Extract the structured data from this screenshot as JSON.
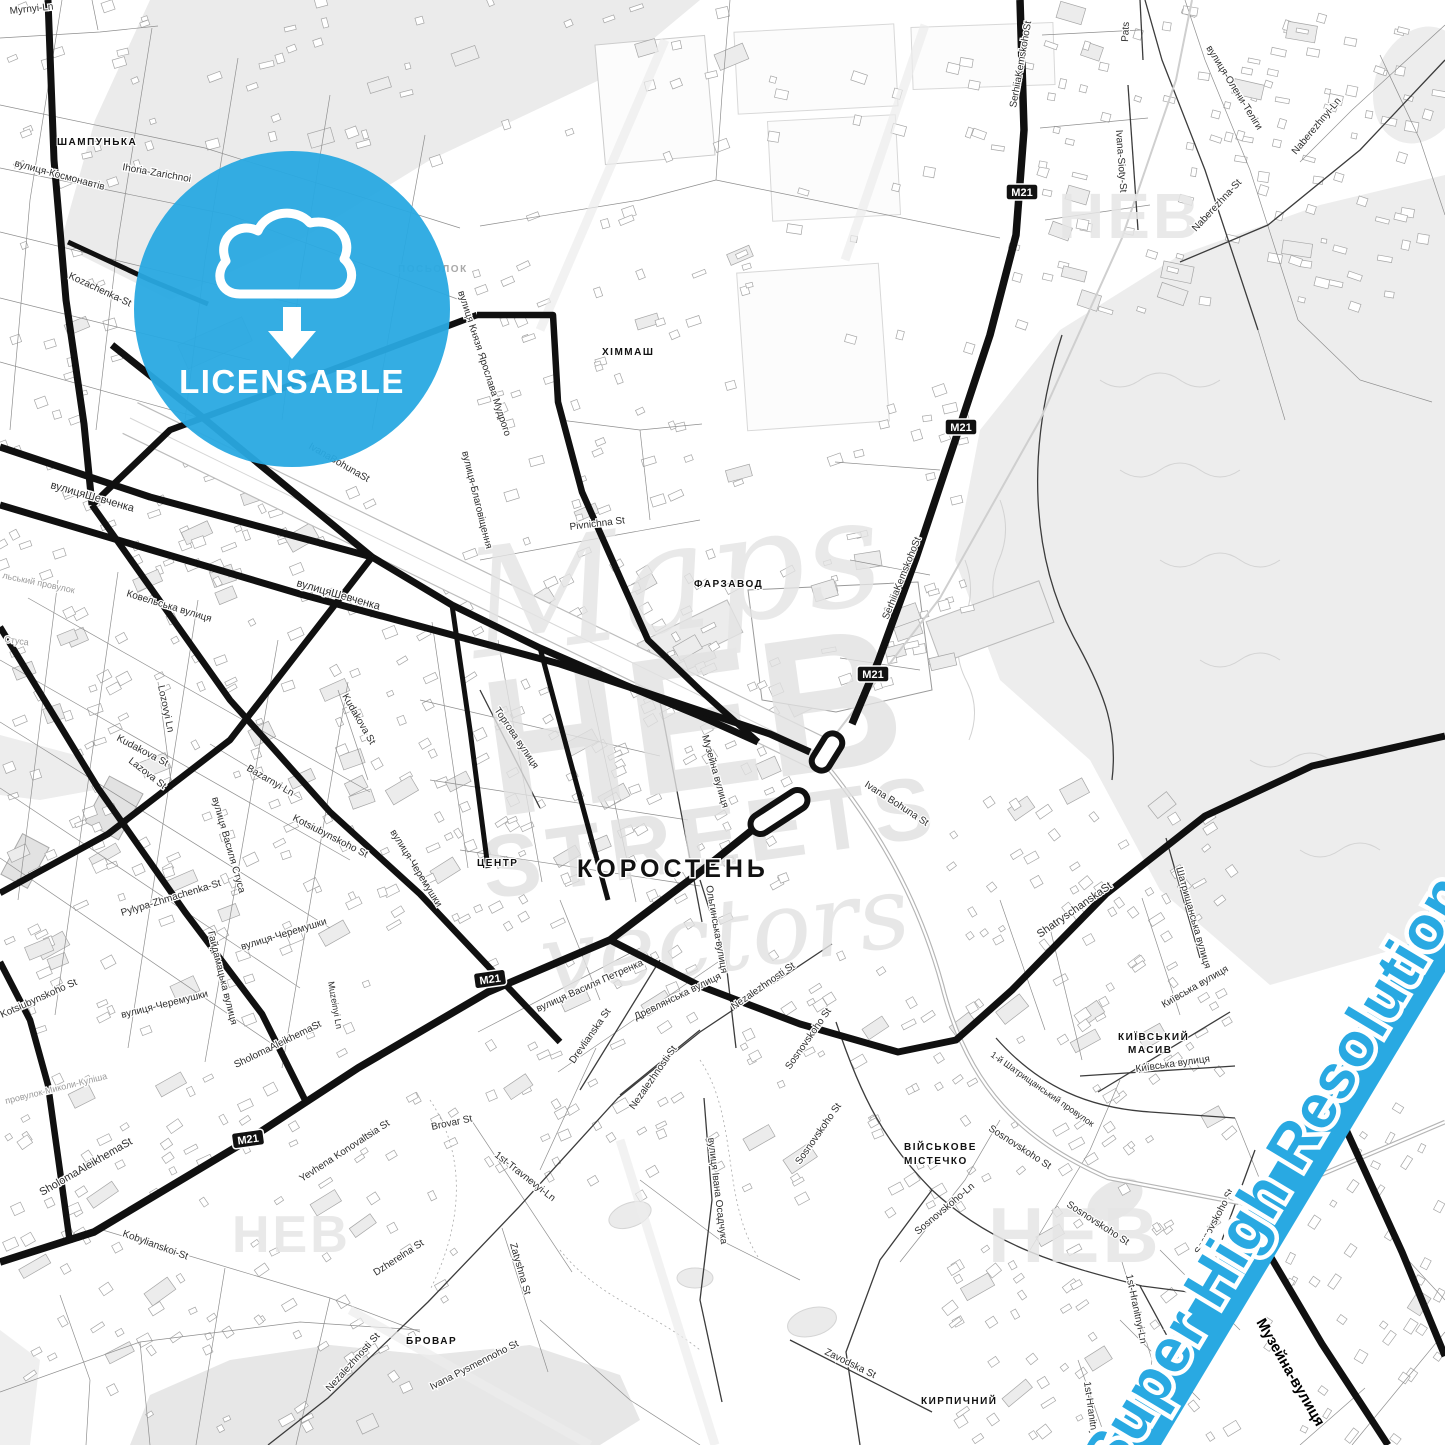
{
  "badge": {
    "label": "LICENSABLE",
    "color": "#29a9e2",
    "icon": "cloud-download"
  },
  "river_label": "Super High Resolution",
  "river_color": "#29a9e2",
  "shield_label": "M21",
  "shields": [
    {
      "x": 1022,
      "y": 192,
      "r": 0
    },
    {
      "x": 961,
      "y": 427,
      "r": 0
    },
    {
      "x": 873,
      "y": 674,
      "r": 0
    },
    {
      "x": 490,
      "y": 979,
      "r": -8
    },
    {
      "x": 248,
      "y": 1139,
      "r": -8
    }
  ],
  "watermark": {
    "line1": "Maps",
    "line2": "HEB",
    "line3": "STREETS",
    "line4": "vectors",
    "corner": "HEB"
  },
  "districts": [
    {
      "t": "ШАМПУНЬКА",
      "x": 57,
      "y": 145,
      "s": 10,
      "g": 0
    },
    {
      "t": "ПОСЬОЛОК",
      "x": 398,
      "y": 272,
      "s": 10,
      "g": 1
    },
    {
      "t": "ХІММАШ",
      "x": 602,
      "y": 355,
      "s": 10,
      "g": 0
    },
    {
      "t": "ФАРЗАВОД",
      "x": 694,
      "y": 587,
      "s": 10,
      "g": 0
    },
    {
      "t": "ЦЕНТР",
      "x": 477,
      "y": 866,
      "s": 10,
      "g": 0
    },
    {
      "t": "КОРОСТЕНЬ",
      "x": 577,
      "y": 877,
      "s": 25,
      "g": 0
    },
    {
      "t": "КИЇВСЬКИЙ",
      "x": 1118,
      "y": 1040,
      "s": 10,
      "g": 0
    },
    {
      "t": "МАСИВ",
      "x": 1128,
      "y": 1053,
      "s": 10,
      "g": 0
    },
    {
      "t": "ВІЙСЬКОВЕ",
      "x": 904,
      "y": 1150,
      "s": 10,
      "g": 0
    },
    {
      "t": "МІСТЕЧКО",
      "x": 904,
      "y": 1164,
      "s": 10,
      "g": 0
    },
    {
      "t": "БРОВАР",
      "x": 406,
      "y": 1344,
      "s": 10,
      "g": 0
    },
    {
      "t": "КИРПИЧНИЙ",
      "x": 921,
      "y": 1404,
      "s": 10,
      "g": 0
    }
  ],
  "streets": [
    {
      "t": "Myrnyi-Ln",
      "x": 10,
      "y": 14,
      "r": -6,
      "s": 10,
      "c": "d"
    },
    {
      "t": "вулиця-Космонавтів",
      "x": 14,
      "y": 166,
      "r": 15,
      "s": 10,
      "c": "d"
    },
    {
      "t": "Ihoria-Zarichnoi",
      "x": 122,
      "y": 170,
      "r": 10,
      "s": 10,
      "c": "d"
    },
    {
      "t": "Kozachenka-St",
      "x": 68,
      "y": 278,
      "r": 25,
      "s": 10,
      "c": "d"
    },
    {
      "t": "вулиця Князя Ярослава Мудрого",
      "x": 458,
      "y": 292,
      "r": 72,
      "s": 10,
      "c": "d"
    },
    {
      "t": "вулиця-Благовіщення",
      "x": 462,
      "y": 452,
      "r": 76,
      "s": 10,
      "c": "d"
    },
    {
      "t": "Pivnichna St",
      "x": 570,
      "y": 530,
      "r": -7,
      "s": 10,
      "c": "d"
    },
    {
      "t": "вулицяШевченка",
      "x": 50,
      "y": 488,
      "r": 16,
      "s": 11,
      "c": "d"
    },
    {
      "t": "вулицяШевченка",
      "x": 296,
      "y": 586,
      "r": 16,
      "s": 11,
      "c": "d"
    },
    {
      "t": "IvanaBohunaSt",
      "x": 308,
      "y": 448,
      "r": 30,
      "s": 10,
      "c": "d"
    },
    {
      "t": "Ковельська вулиця",
      "x": 126,
      "y": 596,
      "r": 17,
      "s": 10,
      "c": "d"
    },
    {
      "t": "льський провулок",
      "x": 2,
      "y": 578,
      "r": 12,
      "s": 9,
      "c": "g"
    },
    {
      "t": "Стуса",
      "x": 4,
      "y": 642,
      "r": 8,
      "s": 9,
      "c": "g"
    },
    {
      "t": "Lozovyi Ln",
      "x": 158,
      "y": 686,
      "r": 78,
      "s": 10,
      "c": "d"
    },
    {
      "t": "Kudakova St",
      "x": 116,
      "y": 740,
      "r": 28,
      "s": 10,
      "c": "d"
    },
    {
      "t": "Kudakova St",
      "x": 342,
      "y": 696,
      "r": 60,
      "s": 10,
      "c": "d"
    },
    {
      "t": "Lazova St",
      "x": 128,
      "y": 762,
      "r": 38,
      "s": 10,
      "c": "d"
    },
    {
      "t": "Bazarnyi Ln",
      "x": 246,
      "y": 770,
      "r": 30,
      "s": 10,
      "c": "d"
    },
    {
      "t": "вулиця Василя Стуса",
      "x": 212,
      "y": 798,
      "r": 74,
      "s": 10,
      "c": "d"
    },
    {
      "t": "Kotsiubynskoho St",
      "x": 292,
      "y": 820,
      "r": 27,
      "s": 10,
      "c": "d"
    },
    {
      "t": "вулиця-Черемушки",
      "x": 390,
      "y": 832,
      "r": 58,
      "s": 10,
      "c": "d"
    },
    {
      "t": "Pylypa-Zhmachenka-St",
      "x": 122,
      "y": 916,
      "r": -17,
      "s": 10,
      "c": "d"
    },
    {
      "t": "вулиця-Черемушки",
      "x": 242,
      "y": 950,
      "r": -17,
      "s": 10,
      "c": "d"
    },
    {
      "t": "Гайдамацька вулиця",
      "x": 208,
      "y": 932,
      "r": 76,
      "s": 10,
      "c": "d"
    },
    {
      "t": "вулиця-Черемушки",
      "x": 122,
      "y": 1018,
      "r": -14,
      "s": 10,
      "c": "d"
    },
    {
      "t": "Kotsiubynskoho St",
      "x": 2,
      "y": 1018,
      "r": -24,
      "s": 10,
      "c": "d"
    },
    {
      "t": "Muzeinyi Ln",
      "x": 328,
      "y": 982,
      "r": 80,
      "s": 9,
      "c": "d"
    },
    {
      "t": "SholomaAleikhemaSt",
      "x": 236,
      "y": 1068,
      "r": -26,
      "s": 10,
      "c": "d"
    },
    {
      "t": "SholomaAleikhemaSt",
      "x": 42,
      "y": 1196,
      "r": -30,
      "s": 11,
      "c": "d"
    },
    {
      "t": "провулок-Миколи-Куліша",
      "x": 6,
      "y": 1104,
      "r": -14,
      "s": 9,
      "c": "g"
    },
    {
      "t": "Kobylianskoi-St",
      "x": 122,
      "y": 1236,
      "r": 20,
      "s": 10,
      "c": "d"
    },
    {
      "t": "Yevhena Konovaltsia St",
      "x": 302,
      "y": 1182,
      "r": -33,
      "s": 10,
      "c": "d"
    },
    {
      "t": "Brovar St",
      "x": 432,
      "y": 1130,
      "r": -12,
      "s": 10,
      "c": "d"
    },
    {
      "t": "Dzherelna St",
      "x": 376,
      "y": 1276,
      "r": -33,
      "s": 10,
      "c": "d"
    },
    {
      "t": "Nezalezhnosti St",
      "x": 330,
      "y": 1392,
      "r": -48,
      "s": 10,
      "c": "d"
    },
    {
      "t": "Ivana Pysmennoho St",
      "x": 432,
      "y": 1390,
      "r": -27,
      "s": 10,
      "c": "d"
    },
    {
      "t": "1st-Travnevyi-Ln",
      "x": 494,
      "y": 1156,
      "r": 38,
      "s": 10,
      "c": "d"
    },
    {
      "t": "Zatyshna St",
      "x": 510,
      "y": 1244,
      "r": 74,
      "s": 10,
      "c": "d"
    },
    {
      "t": "вулиця Василя Петренка",
      "x": 538,
      "y": 1012,
      "r": -24,
      "s": 10,
      "c": "d"
    },
    {
      "t": "Древлянська вулиця",
      "x": 636,
      "y": 1020,
      "r": -26,
      "s": 10,
      "c": "d"
    },
    {
      "t": "Drevlianska St",
      "x": 574,
      "y": 1064,
      "r": -55,
      "s": 10,
      "c": "d"
    },
    {
      "t": "Nezalezhnosti St",
      "x": 634,
      "y": 1110,
      "r": -55,
      "s": 10,
      "c": "d"
    },
    {
      "t": "Nezalezhnosti St",
      "x": 734,
      "y": 1010,
      "r": -35,
      "s": 10,
      "c": "d"
    },
    {
      "t": "вулиця Івана Осадчука",
      "x": 708,
      "y": 1138,
      "r": 83,
      "s": 10,
      "c": "d"
    },
    {
      "t": "Sosnovskoho St",
      "x": 790,
      "y": 1070,
      "r": -55,
      "s": 10,
      "c": "d"
    },
    {
      "t": "Sosnovskoho St",
      "x": 800,
      "y": 1165,
      "r": -55,
      "s": 10,
      "c": "d"
    },
    {
      "t": "Sosnovskoho St",
      "x": 988,
      "y": 1130,
      "r": 33,
      "s": 10,
      "c": "d"
    },
    {
      "t": "Sosnovskoho-Ln",
      "x": 918,
      "y": 1235,
      "r": -40,
      "s": 10,
      "c": "d"
    },
    {
      "t": "Sosnovskoho St",
      "x": 1066,
      "y": 1206,
      "r": 33,
      "s": 10,
      "c": "d"
    },
    {
      "t": "Sosnovskoho St",
      "x": 1200,
      "y": 1255,
      "r": -62,
      "s": 10,
      "c": "d"
    },
    {
      "t": "Zavodska St",
      "x": 824,
      "y": 1354,
      "r": 26,
      "s": 10,
      "c": "d"
    },
    {
      "t": "1st-Hranitnyi-Ln",
      "x": 1126,
      "y": 1275,
      "r": 78,
      "s": 10,
      "c": "d"
    },
    {
      "t": "1st-Hranitnyi-Ln",
      "x": 1084,
      "y": 1382,
      "r": 82,
      "s": 10,
      "c": "d"
    },
    {
      "t": "Музейна-вулиця",
      "x": 1256,
      "y": 1322,
      "r": 60,
      "s": 15,
      "c": "b"
    },
    {
      "t": "Торгова вулиця",
      "x": 494,
      "y": 710,
      "r": 56,
      "s": 10,
      "c": "d"
    },
    {
      "t": "Музейна вулиця",
      "x": 702,
      "y": 736,
      "r": 74,
      "s": 10,
      "c": "d"
    },
    {
      "t": "Ольгинська вулиця",
      "x": 706,
      "y": 886,
      "r": 80,
      "s": 10,
      "c": "d"
    },
    {
      "t": "Ivana Bohuna St",
      "x": 864,
      "y": 786,
      "r": 33,
      "s": 10,
      "c": "d"
    },
    {
      "t": "SerhiiaKemskohoSt",
      "x": 888,
      "y": 620,
      "r": -68,
      "s": 10,
      "c": "d"
    },
    {
      "t": "SerhiiaKemskohoSt",
      "x": 1016,
      "y": 108,
      "r": -80,
      "s": 10,
      "c": "d"
    },
    {
      "t": "Pats",
      "x": 1128,
      "y": 42,
      "r": -87,
      "s": 10,
      "c": "d"
    },
    {
      "t": "вулиця-Олени-Теліги",
      "x": 1206,
      "y": 48,
      "r": 58,
      "s": 10,
      "c": "d"
    },
    {
      "t": "Ivana-Sioty-St",
      "x": 1116,
      "y": 130,
      "r": 86,
      "s": 10,
      "c": "d"
    },
    {
      "t": "Naberezhna-St",
      "x": 1196,
      "y": 232,
      "r": -47,
      "s": 10,
      "c": "d"
    },
    {
      "t": "Naberezhnyi-Ln",
      "x": 1296,
      "y": 155,
      "r": -50,
      "s": 10,
      "c": "d"
    },
    {
      "t": "ShatryschanskaSt",
      "x": 1040,
      "y": 938,
      "r": -35,
      "s": 11,
      "c": "d"
    },
    {
      "t": "Шатрищанська вулиця",
      "x": 1176,
      "y": 868,
      "r": 74,
      "s": 10,
      "c": "d"
    },
    {
      "t": "Київська вулиця",
      "x": 1164,
      "y": 1008,
      "r": -30,
      "s": 10,
      "c": "d"
    },
    {
      "t": "Київська вулиця",
      "x": 1136,
      "y": 1072,
      "r": -8,
      "s": 10,
      "c": "d"
    },
    {
      "t": "1-й Шатрищанський провулок",
      "x": 990,
      "y": 1056,
      "r": 35,
      "s": 9,
      "c": "d"
    }
  ]
}
